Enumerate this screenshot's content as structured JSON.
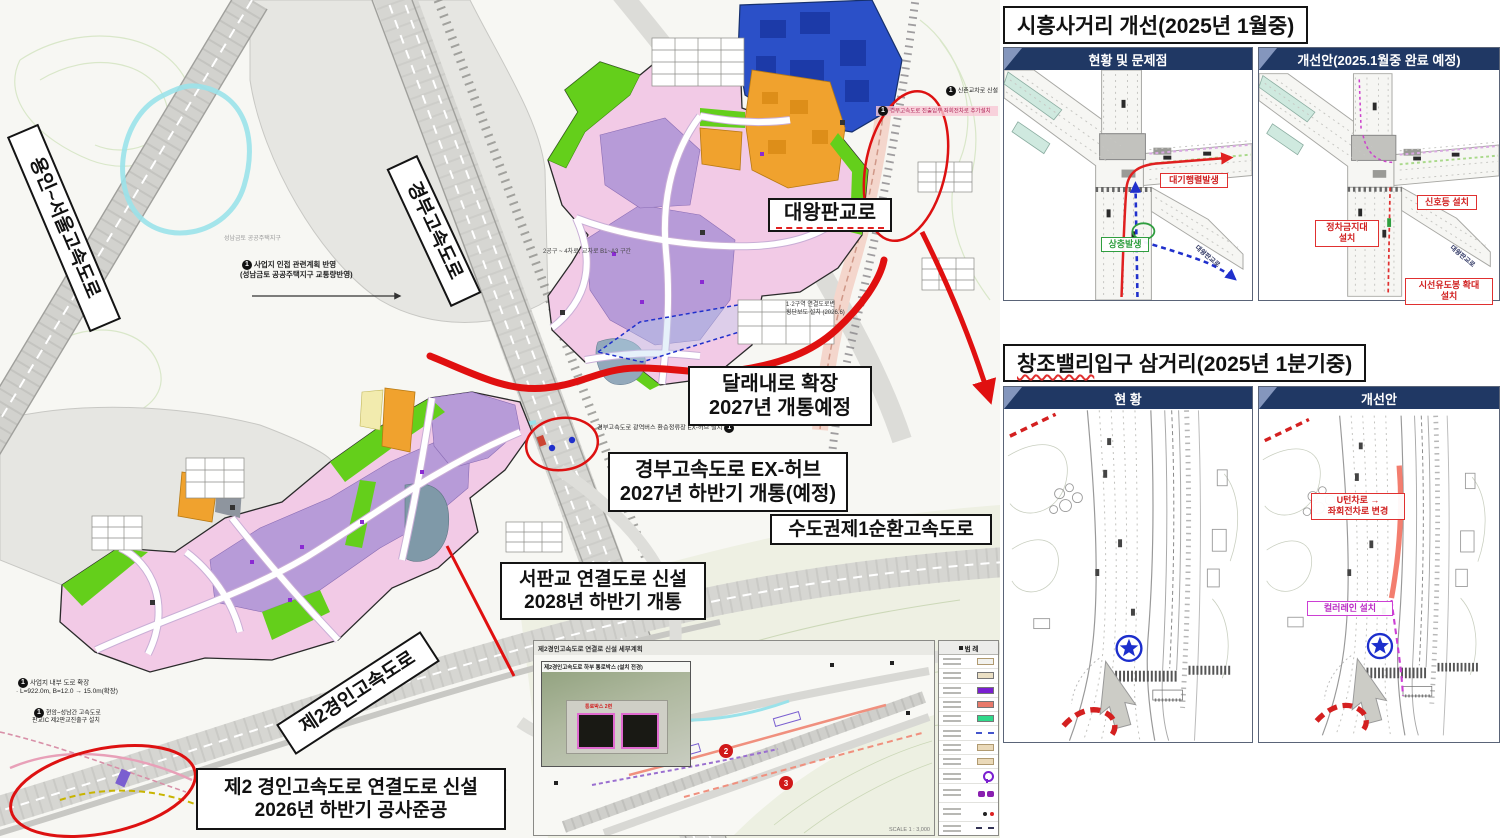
{
  "colors": {
    "red": "#e01010",
    "navy": "#203864",
    "magenta": "#cc3fd4",
    "green_label": "#2f9e3f",
    "blue_arrow": "#2030cc",
    "salmon_line": "#f2705f",
    "star_blue": "#1c2ecc",
    "pink_zone": "#f2cae6",
    "purple_zone": "#b79bd8",
    "green_zone": "#64cf1b",
    "orange_zone": "#f0a22e",
    "yellow_zone": "#f2ebae",
    "blue_zone": "#2b50c8"
  },
  "badge_char": "1",
  "map": {
    "road_labels": {
      "yongin_seoul": "용인~서울고속도로",
      "gyeongbu": "경부고속도로",
      "daewang_pangyo": "대왕판교로",
      "sunhwan": "수도권제1순환고속도로",
      "je2_gyeongin": "제2경인고속도로"
    },
    "callouts": {
      "dallaenae": {
        "line1": "달래내로 확장",
        "line2": "2027년 개통예정"
      },
      "ex_hub": {
        "line1": "경부고속도로 EX-허브",
        "line2": "2027년 하반기 개통(예정)"
      },
      "seopangyo": {
        "line1": "서판교 연결도로 신설",
        "line2": "2028년 하반기 개통"
      },
      "je2_connect": {
        "line1": "제2 경인고속도로 연결도로 신설",
        "line2": "2026년 하반기 공사준공"
      }
    },
    "notes": [
      {
        "name": "note-adjacent-plan",
        "x": 240,
        "y": 260,
        "w": 175,
        "size": 7.5,
        "color": "#222",
        "weight": 700,
        "align": "left",
        "badge": "left",
        "text": "사업지 인접 관련계획 반영\n(성남금토 공공주택지구 교통량반영)"
      },
      {
        "name": "note-sinchon",
        "x": 924,
        "y": 86,
        "w": 74,
        "size": 6,
        "color": "#222",
        "align": "right",
        "badge": "left",
        "text": "신촌교차로 신설"
      },
      {
        "name": "note-leftturn",
        "x": 876,
        "y": 106,
        "w": 122,
        "size": 5.5,
        "color": "#b02858",
        "bg": "rgba(248,199,212,0.8)",
        "align": "left",
        "badge": "left",
        "text": "경부고속도로 진출입부 좌회전차로 추가설치"
      },
      {
        "name": "note-exhub",
        "x": 597,
        "y": 423,
        "w": 158,
        "size": 6.2,
        "color": "#222",
        "align": "left",
        "badge": "right",
        "text": "경부고속도로 광역버스 환승정류장 EX-허브 설치"
      },
      {
        "name": "note-section",
        "x": 543,
        "y": 249,
        "w": 132,
        "size": 6,
        "color": "#444",
        "align": "left",
        "text": "2공구 ~ 4차로, 교차로 B1~A3 구간"
      },
      {
        "name": "note-crosswalk",
        "x": 786,
        "y": 302,
        "w": 96,
        "size": 6,
        "color": "#333",
        "align": "left",
        "text": "1·2구역 연결도로변\n횡단보도 설치 (2026.6)"
      },
      {
        "name": "note-inner-road",
        "x": 16,
        "y": 678,
        "w": 155,
        "size": 6.5,
        "color": "#222",
        "align": "left",
        "badge": "left",
        "text": "사업지 내부 도로 확장\n· L=922.0m, B=12.0 → 15.0m(확장)"
      },
      {
        "name": "note-pangyo-ic",
        "x": 32,
        "y": 708,
        "w": 132,
        "size": 6,
        "color": "#222",
        "align": "left",
        "badge": "left",
        "text": "현암~성남간 고속도로\n판교IC 제2판교진출구 설치"
      },
      {
        "name": "note-geumto",
        "x": 224,
        "y": 236,
        "w": 120,
        "size": 6,
        "color": "#999",
        "align": "left",
        "text": "성남금토 공공주택지구"
      },
      {
        "name": "note-pangyo-district",
        "x": 648,
        "y": 588,
        "w": 60,
        "size": 6,
        "color": "#999",
        "align": "left",
        "text": "판교지구"
      },
      {
        "name": "note-scale",
        "x": 446,
        "y": 824,
        "w": 82,
        "size": 5.5,
        "color": "#777",
        "align": "left",
        "text": "SCALE 1 : 3,000"
      }
    ],
    "inset": {
      "title": "제2경인고속도로 연결로 신설 세부계획",
      "photo_caption": "제2경인고속도로 하부 통로박스 (설치 전경)",
      "tunnel_label": "통로박스 2련",
      "badges": [
        "2",
        "3"
      ],
      "scale": "SCALE 1 : 3,000"
    },
    "legend": {
      "title": "범 례",
      "rows": [
        {
          "kind": "box-outline",
          "color": "#f2f2ee"
        },
        {
          "kind": "box",
          "color": "#eadfc4"
        },
        {
          "kind": "box",
          "color": "#7a1fd0"
        },
        {
          "kind": "box",
          "color": "#e8796a"
        },
        {
          "kind": "box",
          "color": "#2fd98a"
        },
        {
          "kind": "line-dashed",
          "color": "#4455cc"
        },
        {
          "kind": "box-outline",
          "color": "#ead9b8"
        },
        {
          "kind": "box-outline",
          "color": "#ead9b8"
        },
        {
          "kind": "pin",
          "color": "#7a1fd0"
        },
        {
          "kind": "blobs",
          "color": "#8a1fb0"
        },
        {
          "kind": "dots",
          "color": "#222222"
        },
        {
          "kind": "line-dashed",
          "color": "#333355"
        }
      ]
    }
  },
  "sections": {
    "siheung": {
      "title": "시흥사거리 개선(2025년 1월중)",
      "left_header": "현황 및 문제점",
      "right_header": "개선안(2025.1월중 완료 예정)"
    },
    "changjo": {
      "title_highlight": "창조밸리",
      "title_rest": " 입구 삼거리(2025년 1분기중)",
      "left_header": "현 황",
      "right_header": "개선안"
    }
  },
  "overlays": [
    {
      "panel": "p1l",
      "name": "label-queue",
      "cls": "red",
      "x": 156,
      "y": 103,
      "w": 68,
      "text": "대기행렬발생"
    },
    {
      "panel": "p1l",
      "name": "label-conflict",
      "cls": "green",
      "x": 97,
      "y": 167,
      "w": 48,
      "text": "상충발생"
    },
    {
      "panel": "p1l",
      "name": "road-label-daewang",
      "cls": "roadname",
      "x": 196,
      "y": 172,
      "rot": 40,
      "text": "대왕판교로"
    },
    {
      "panel": "p1r",
      "name": "label-signal",
      "cls": "red",
      "x": 158,
      "y": 125,
      "w": 60,
      "text": "신호등 설치"
    },
    {
      "panel": "p1r",
      "name": "label-no-stopping",
      "cls": "red",
      "x": 56,
      "y": 150,
      "w": 64,
      "text": "정차금지대\n설치"
    },
    {
      "panel": "p1r",
      "name": "label-delineator",
      "cls": "red",
      "x": 146,
      "y": 208,
      "w": 88,
      "text": "시선유도봉 확대\n설치"
    },
    {
      "panel": "p1r",
      "name": "road-label-daewang",
      "cls": "roadname",
      "x": 196,
      "y": 172,
      "rot": 40,
      "text": "대왕판교로"
    },
    {
      "panel": "p2r",
      "name": "label-uturn-change",
      "cls": "red",
      "x": 52,
      "y": 84,
      "w": 94,
      "text": "U턴차로 →\n좌회전차로 변경"
    },
    {
      "panel": "p2r",
      "name": "label-color-lane",
      "cls": "magenta",
      "x": 48,
      "y": 192,
      "w": 86,
      "text": "컬러레인 설치"
    }
  ]
}
